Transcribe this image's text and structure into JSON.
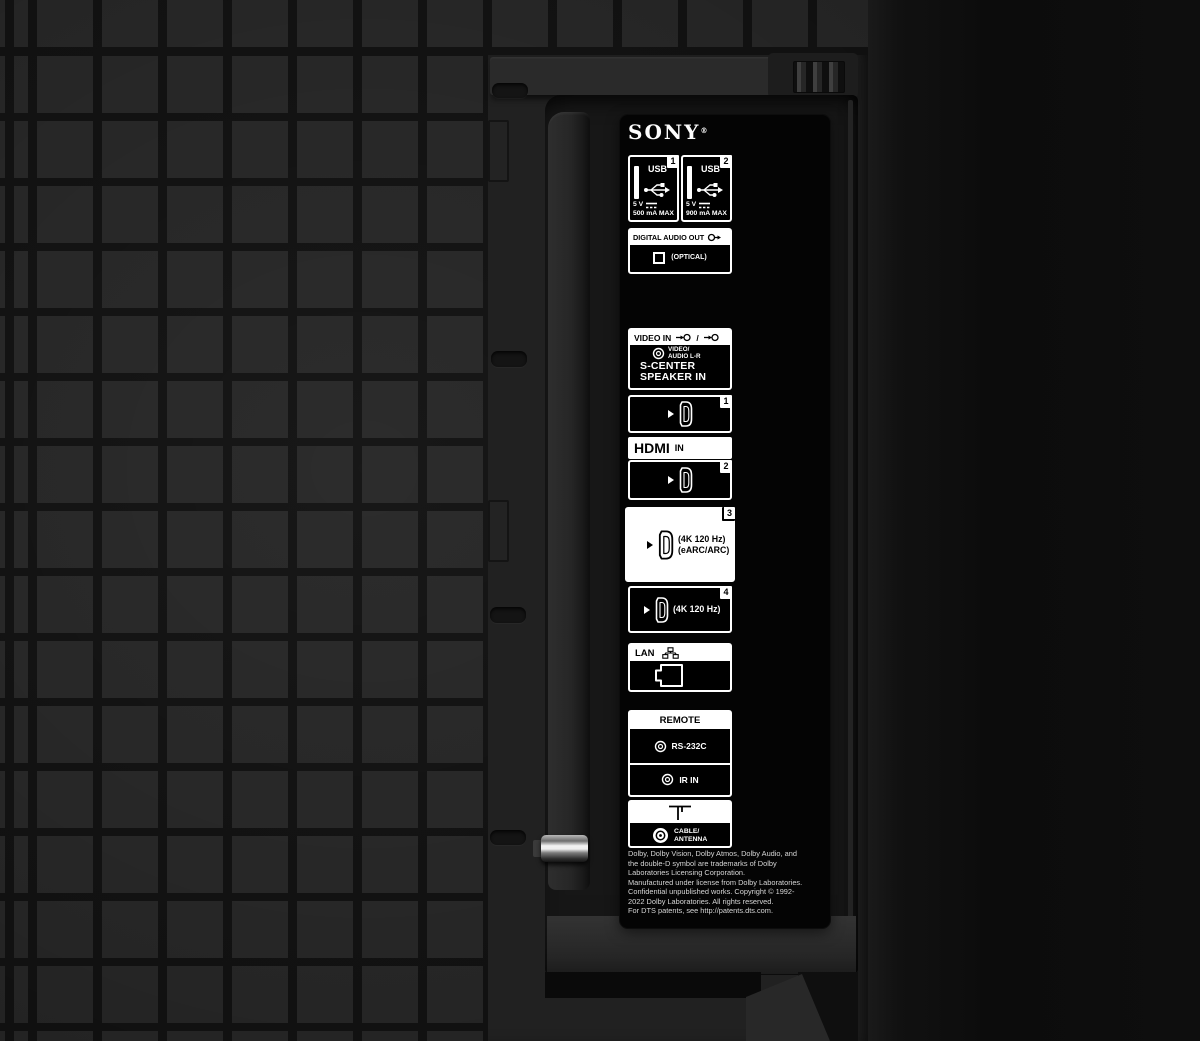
{
  "brand": {
    "name": "SONY",
    "registered": "®"
  },
  "colors": {
    "label_white": "#ffffff",
    "plate_black": "#040404",
    "grid_square": "#272727",
    "grid_gap": "#121212",
    "highlight_port_bg": "#ffffff"
  },
  "usb_ports": [
    {
      "number": "1",
      "label": "USB",
      "voltage": "5 V",
      "current": "500 mA MAX"
    },
    {
      "number": "2",
      "label": "USB",
      "voltage": "5 V",
      "current": "900 mA MAX"
    }
  ],
  "digital_audio_out": {
    "label": "DIGITAL AUDIO OUT",
    "mode": "(OPTICAL)"
  },
  "video_in": {
    "label": "VIDEO IN",
    "icon_separator": "/",
    "jack_line1": "VIDEO/",
    "jack_line2": "AUDIO L-R",
    "center_line1": "S-CENTER",
    "center_line2": "SPEAKER IN"
  },
  "hdmi": {
    "logo": "HDMI",
    "suffix": "IN",
    "port1": {
      "number": "1"
    },
    "port2": {
      "number": "2"
    },
    "port3": {
      "number": "3",
      "caption1": "(4K 120 Hz)",
      "caption2": "(eARC/ARC)"
    },
    "port4": {
      "number": "4",
      "caption1": "(4K 120 Hz)"
    }
  },
  "lan": {
    "label": "LAN"
  },
  "remote": {
    "label": "REMOTE",
    "port1": "RS-232C",
    "port2": "IR IN"
  },
  "antenna": {
    "line1": "CABLE/",
    "line2": "ANTENNA"
  },
  "legal": {
    "line1": "Dolby, Dolby Vision, Dolby Atmos, Dolby Audio, and",
    "line2": "the double-D symbol are trademarks of Dolby",
    "line3": "Laboratories Licensing Corporation.",
    "line4": "Manufactured under license from Dolby Laboratories.",
    "line5": "Confidential unpublished works. Copyright © 1992-",
    "line6": "2022 Dolby Laboratories. All rights reserved.",
    "line7": "For DTS patents, see http://patents.dts.com."
  }
}
